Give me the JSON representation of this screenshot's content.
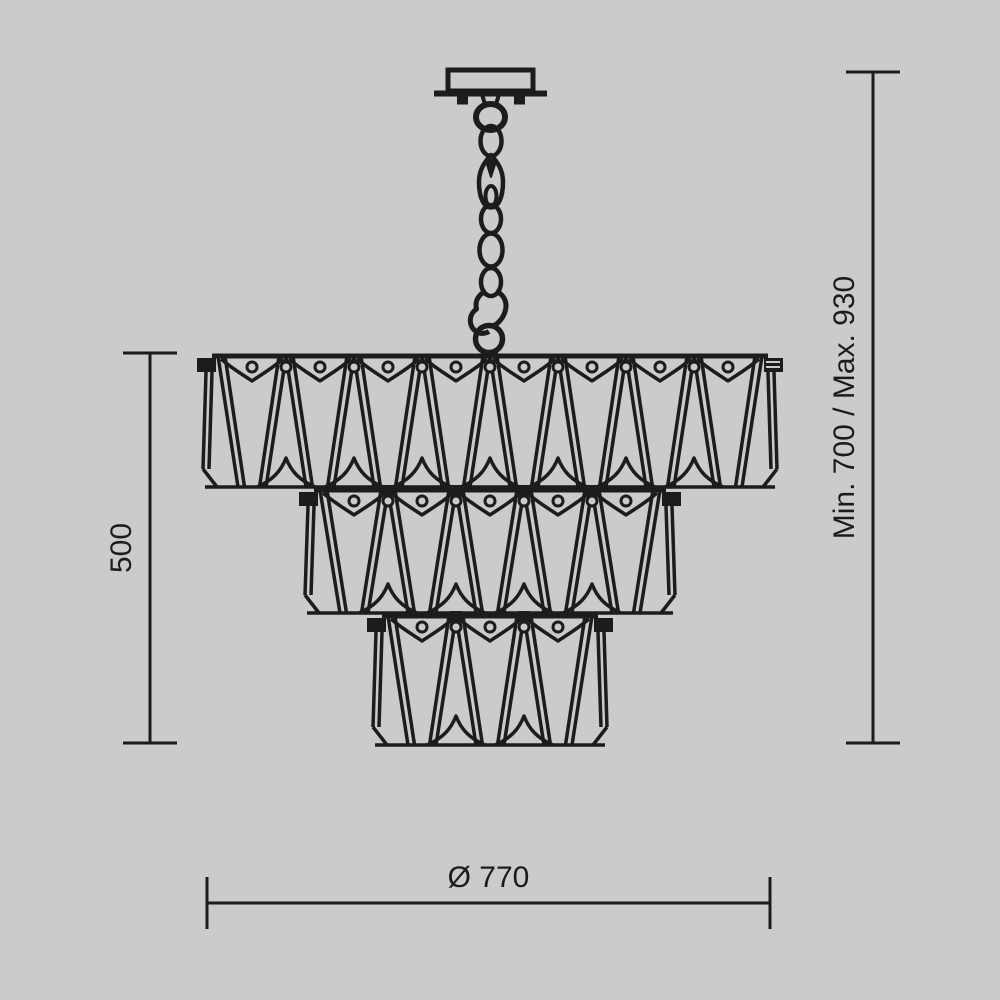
{
  "labels": {
    "height": "500",
    "suspension": "Min. 700 / Max. 930",
    "diameter": "Ø 770"
  },
  "colors": {
    "background": "#cbcbcb",
    "ink": "#1c1c1c"
  },
  "figure": {
    "type": "technical-dimension-drawing",
    "subject": "three-tier crystal chandelier on chain suspension",
    "center_x": 490,
    "crystal_pitch": 68,
    "tiers": [
      {
        "crystals": 8,
        "y_top": 356,
        "y_bottom": 487
      },
      {
        "crystals": 5,
        "y_top": 490,
        "y_bottom": 613
      },
      {
        "crystals": 3,
        "y_top": 616,
        "y_bottom": 745
      }
    ],
    "dim_left": {
      "x": 150,
      "y1": 353,
      "y2": 743,
      "cap": 27,
      "label_key": "height"
    },
    "dim_right": {
      "x": 873,
      "y1": 72,
      "y2": 743,
      "cap": 27,
      "label_key": "suspension"
    },
    "dim_bottom": {
      "y": 903,
      "x1": 207,
      "x2": 770,
      "cap": 26,
      "label_key": "diameter"
    }
  }
}
